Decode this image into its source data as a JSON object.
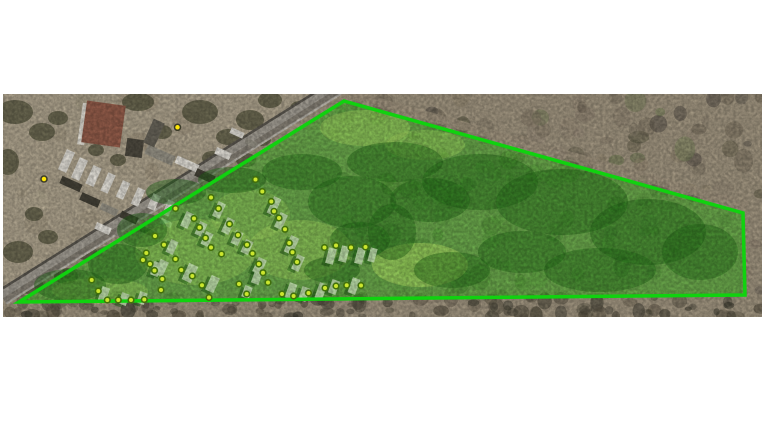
{
  "scene": {
    "canvas": {
      "w": 762,
      "h": 445,
      "bg": "#ffffff"
    },
    "photo": {
      "x": 3,
      "y": 94,
      "w": 759,
      "h": 223,
      "base": "#a89c86"
    },
    "industrial": {
      "points": [
        [
          3,
          94
        ],
        [
          333,
          94
        ],
        [
          3,
          302
        ]
      ],
      "fill": "#b6ab94"
    },
    "textures": [
      {
        "x": 330,
        "y": 94,
        "w": 432,
        "h": 206,
        "count": 170,
        "palette": [
          "#857a68",
          "#6f6656",
          "#5c5a44",
          "#7e8a5f",
          "#93876f",
          "#565048",
          "#6b7a4e",
          "#9a8d7a"
        ],
        "rmin": 4,
        "rmax": 11,
        "opacity": 0.55,
        "seed": 7
      },
      {
        "x": 3,
        "y": 297,
        "w": 759,
        "h": 20,
        "count": 110,
        "palette": [
          "#4e4a3c",
          "#5d5747",
          "#3f3e32",
          "#6c6452",
          "#57503f"
        ],
        "rmin": 3,
        "rmax": 8,
        "opacity": 0.65,
        "seed": 13
      },
      {
        "x": 3,
        "y": 94,
        "w": 310,
        "h": 205,
        "count": 45,
        "palette": [
          "#a99e87",
          "#978c74",
          "#b7ac94",
          "#c3b89f"
        ],
        "rmin": 5,
        "rmax": 13,
        "opacity": 0.4,
        "seed": 21
      }
    ],
    "trees": {
      "color": "#57573f",
      "opacity": 0.75,
      "items": [
        [
          15,
          112,
          18,
          12
        ],
        [
          42,
          132,
          13,
          9
        ],
        [
          8,
          162,
          11,
          13
        ],
        [
          138,
          102,
          16,
          9
        ],
        [
          200,
          112,
          18,
          12
        ],
        [
          228,
          137,
          12,
          8
        ],
        [
          162,
          132,
          10,
          7
        ],
        [
          96,
          150,
          8,
          6
        ],
        [
          212,
          158,
          10,
          7
        ],
        [
          18,
          252,
          15,
          11
        ],
        [
          48,
          237,
          10,
          7
        ],
        [
          86,
          252,
          11,
          8
        ],
        [
          250,
          120,
          14,
          10
        ],
        [
          270,
          100,
          12,
          8
        ],
        [
          300,
          108,
          10,
          7
        ],
        [
          58,
          118,
          10,
          7
        ],
        [
          118,
          160,
          8,
          6
        ],
        [
          34,
          214,
          9,
          7
        ],
        [
          66,
          276,
          12,
          8
        ],
        [
          30,
          286,
          14,
          8
        ],
        [
          246,
          160,
          10,
          7
        ],
        [
          262,
          140,
          9,
          6
        ]
      ]
    },
    "road": {
      "from": [
        337,
        87
      ],
      "to": [
        2,
        297
      ],
      "bands": [
        {
          "width": 16,
          "color": "#a9a49a",
          "offset": 0
        },
        {
          "width": 5,
          "color": "#8b857a",
          "offset": -4
        },
        {
          "width": 2.5,
          "color": "#5f5b53",
          "offset": 7
        },
        {
          "width": 1.8,
          "color": "#c6c2b8",
          "offset": -8
        }
      ]
    },
    "cleared_strip": {
      "from": [
        342,
        92
      ],
      "to": [
        748,
        206
      ],
      "width": 9,
      "color": "#a89b85",
      "opacity": 0.8
    },
    "buildings": [
      {
        "x": 80,
        "y": 103,
        "w": 7,
        "h": 42,
        "rot": 8,
        "fill": "#e8e4da"
      },
      {
        "x": 84,
        "y": 103,
        "w": 39,
        "h": 42,
        "rot": 8,
        "fill": "#99604d"
      },
      {
        "x": 126,
        "y": 139,
        "w": 17,
        "h": 18,
        "rot": 8,
        "fill": "#514d42"
      },
      {
        "x": 148,
        "y": 120,
        "w": 12,
        "h": 26,
        "rot": 24,
        "fill": "#6b675c"
      }
    ],
    "yard": {
      "colors": {
        "w": "#ece9e1",
        "d": "#474439",
        "g": "#9d998c"
      },
      "items": [
        [
          62,
          150,
          9,
          22,
          24,
          "w"
        ],
        [
          75,
          158,
          9,
          22,
          24,
          "w"
        ],
        [
          89,
          166,
          9,
          20,
          24,
          "w"
        ],
        [
          104,
          173,
          8,
          20,
          24,
          "w"
        ],
        [
          119,
          181,
          8,
          18,
          24,
          "w"
        ],
        [
          134,
          188,
          8,
          18,
          24,
          "w"
        ],
        [
          150,
          194,
          8,
          16,
          24,
          "w"
        ],
        [
          165,
          200,
          7,
          16,
          24,
          "w"
        ],
        [
          60,
          180,
          22,
          8,
          24,
          "d"
        ],
        [
          80,
          196,
          20,
          8,
          24,
          "d"
        ],
        [
          100,
          206,
          18,
          7,
          24,
          "g"
        ],
        [
          120,
          214,
          18,
          7,
          24,
          "d"
        ],
        [
          145,
          150,
          30,
          10,
          24,
          "g"
        ],
        [
          175,
          160,
          24,
          8,
          24,
          "w"
        ],
        [
          195,
          172,
          20,
          8,
          24,
          "d"
        ],
        [
          215,
          150,
          16,
          7,
          24,
          "w"
        ],
        [
          95,
          225,
          16,
          7,
          24,
          "w"
        ],
        [
          115,
          232,
          14,
          6,
          24,
          "g"
        ],
        [
          140,
          228,
          14,
          6,
          24,
          "d"
        ],
        [
          160,
          220,
          12,
          6,
          24,
          "w"
        ],
        [
          230,
          130,
          14,
          6,
          24,
          "w"
        ],
        [
          245,
          140,
          12,
          6,
          24,
          "g"
        ]
      ]
    },
    "parcel": {
      "points": [
        [
          344,
          101
        ],
        [
          743,
          213
        ],
        [
          745,
          295
        ],
        [
          19,
          302
        ]
      ],
      "stroke": "#10d20f",
      "stroke_width": 3.5,
      "fill": "#3fbf22",
      "fill_opacity": 0.55
    },
    "field": {
      "color": "#c4f46e",
      "patches": [
        [
          420,
          265,
          48,
          22,
          0.5
        ],
        [
          300,
          250,
          52,
          30,
          0.32
        ],
        [
          195,
          252,
          60,
          33,
          0.3
        ],
        [
          100,
          291,
          48,
          13,
          0.3
        ],
        [
          365,
          128,
          45,
          18,
          0.38
        ],
        [
          425,
          145,
          40,
          15,
          0.3
        ],
        [
          250,
          215,
          40,
          25,
          0.25
        ]
      ]
    },
    "clumps": {
      "color": "#237019",
      "opacity": 0.45,
      "items": [
        [
          70,
          285,
          36,
          16
        ],
        [
          118,
          264,
          30,
          20
        ],
        [
          142,
          230,
          25,
          17
        ],
        [
          176,
          192,
          30,
          13
        ],
        [
          232,
          180,
          34,
          13
        ],
        [
          302,
          172,
          40,
          18
        ],
        [
          352,
          202,
          44,
          26
        ],
        [
          395,
          162,
          48,
          20
        ],
        [
          332,
          270,
          28,
          13
        ],
        [
          392,
          232,
          24,
          28
        ],
        [
          480,
          182,
          58,
          28
        ],
        [
          562,
          202,
          66,
          33
        ],
        [
          648,
          232,
          58,
          33
        ],
        [
          600,
          270,
          56,
          22
        ],
        [
          700,
          252,
          38,
          28
        ],
        [
          452,
          270,
          38,
          18
        ],
        [
          522,
          252,
          44,
          21
        ],
        [
          430,
          200,
          40,
          22
        ],
        [
          360,
          240,
          30,
          18
        ]
      ]
    },
    "homes": {
      "fill": "#cfeebc",
      "fill_opacity": 0.9,
      "shadow": "#1c5c14",
      "shadow_opacity": 0.5,
      "items": [
        [
          270,
          197,
          8,
          18,
          25
        ],
        [
          277,
          213,
          8,
          16,
          25
        ],
        [
          287,
          236,
          9,
          18,
          25
        ],
        [
          294,
          255,
          8,
          16,
          25
        ],
        [
          215,
          202,
          8,
          16,
          25
        ],
        [
          224,
          218,
          8,
          16,
          25
        ],
        [
          233,
          231,
          8,
          14,
          25
        ],
        [
          243,
          240,
          8,
          14,
          25
        ],
        [
          255,
          258,
          9,
          16,
          25
        ],
        [
          183,
          212,
          8,
          16,
          25
        ],
        [
          197,
          222,
          8,
          14,
          25
        ],
        [
          203,
          232,
          8,
          14,
          25
        ],
        [
          168,
          240,
          8,
          14,
          25
        ],
        [
          157,
          260,
          9,
          16,
          25
        ],
        [
          185,
          264,
          10,
          18,
          25
        ],
        [
          208,
          276,
          9,
          16,
          25
        ],
        [
          327,
          248,
          8,
          16,
          15
        ],
        [
          340,
          246,
          8,
          16,
          15
        ],
        [
          356,
          248,
          8,
          16,
          15
        ],
        [
          369,
          248,
          7,
          14,
          15
        ],
        [
          287,
          283,
          8,
          16,
          20
        ],
        [
          300,
          287,
          8,
          14,
          20
        ],
        [
          317,
          283,
          8,
          16,
          20
        ],
        [
          330,
          280,
          8,
          14,
          20
        ],
        [
          350,
          278,
          8,
          16,
          20
        ],
        [
          253,
          270,
          8,
          14,
          20
        ],
        [
          243,
          286,
          8,
          12,
          20
        ],
        [
          100,
          287,
          8,
          14,
          20
        ],
        [
          120,
          293,
          8,
          12,
          20
        ],
        [
          138,
          292,
          8,
          12,
          20
        ],
        [
          152,
          262,
          8,
          14,
          20
        ]
      ]
    },
    "markers": {
      "inside": {
        "fill": "#cbe62e",
        "stroke": "#42700c",
        "r": 2.8,
        "stroke_width": 1.6,
        "points": [
          [
            91.7,
            280
          ],
          [
            98.3,
            291
          ],
          [
            107.3,
            300
          ],
          [
            118.3,
            300
          ],
          [
            131,
            300
          ],
          [
            144.3,
            299.5
          ],
          [
            146.3,
            253
          ],
          [
            143,
            260
          ],
          [
            150,
            264
          ],
          [
            154.5,
            270.5
          ],
          [
            162.3,
            279
          ],
          [
            161,
            290
          ],
          [
            155,
            236
          ],
          [
            164,
            244.7
          ],
          [
            175.5,
            208.5
          ],
          [
            194,
            218.5
          ],
          [
            199.5,
            227.5
          ],
          [
            205.5,
            238
          ],
          [
            211,
            247.5
          ],
          [
            175.5,
            259
          ],
          [
            181.3,
            270
          ],
          [
            192.3,
            276
          ],
          [
            202,
            285.3
          ],
          [
            211,
            197.5
          ],
          [
            218.5,
            208.5
          ],
          [
            229.5,
            224
          ],
          [
            238,
            235
          ],
          [
            247,
            244.7
          ],
          [
            252.5,
            253.5
          ],
          [
            258.8,
            264
          ],
          [
            263,
            272.7
          ],
          [
            239,
            284
          ],
          [
            246.7,
            294
          ],
          [
            221.5,
            254
          ],
          [
            255.5,
            179.5
          ],
          [
            262.3,
            191.5
          ],
          [
            271.3,
            201.5
          ],
          [
            274,
            211.3
          ],
          [
            279,
            218
          ],
          [
            285,
            229.3
          ],
          [
            289.3,
            243
          ],
          [
            292.5,
            252.3
          ],
          [
            297,
            262
          ],
          [
            268,
            282.5
          ],
          [
            209,
            297.5
          ],
          [
            282,
            294
          ],
          [
            293.6,
            296
          ],
          [
            308.5,
            293
          ],
          [
            325,
            288
          ],
          [
            336,
            286
          ],
          [
            346.7,
            285.3
          ],
          [
            361,
            285.5
          ],
          [
            324.5,
            247.5
          ],
          [
            336,
            245.5
          ],
          [
            351,
            247.5
          ],
          [
            365.5,
            247
          ]
        ]
      },
      "outside": {
        "fill": "#ffe607",
        "stroke": "#3a3a28",
        "r": 3,
        "stroke_width": 1.5,
        "points": [
          [
            44,
            179
          ],
          [
            177.5,
            127.3
          ]
        ]
      }
    }
  }
}
